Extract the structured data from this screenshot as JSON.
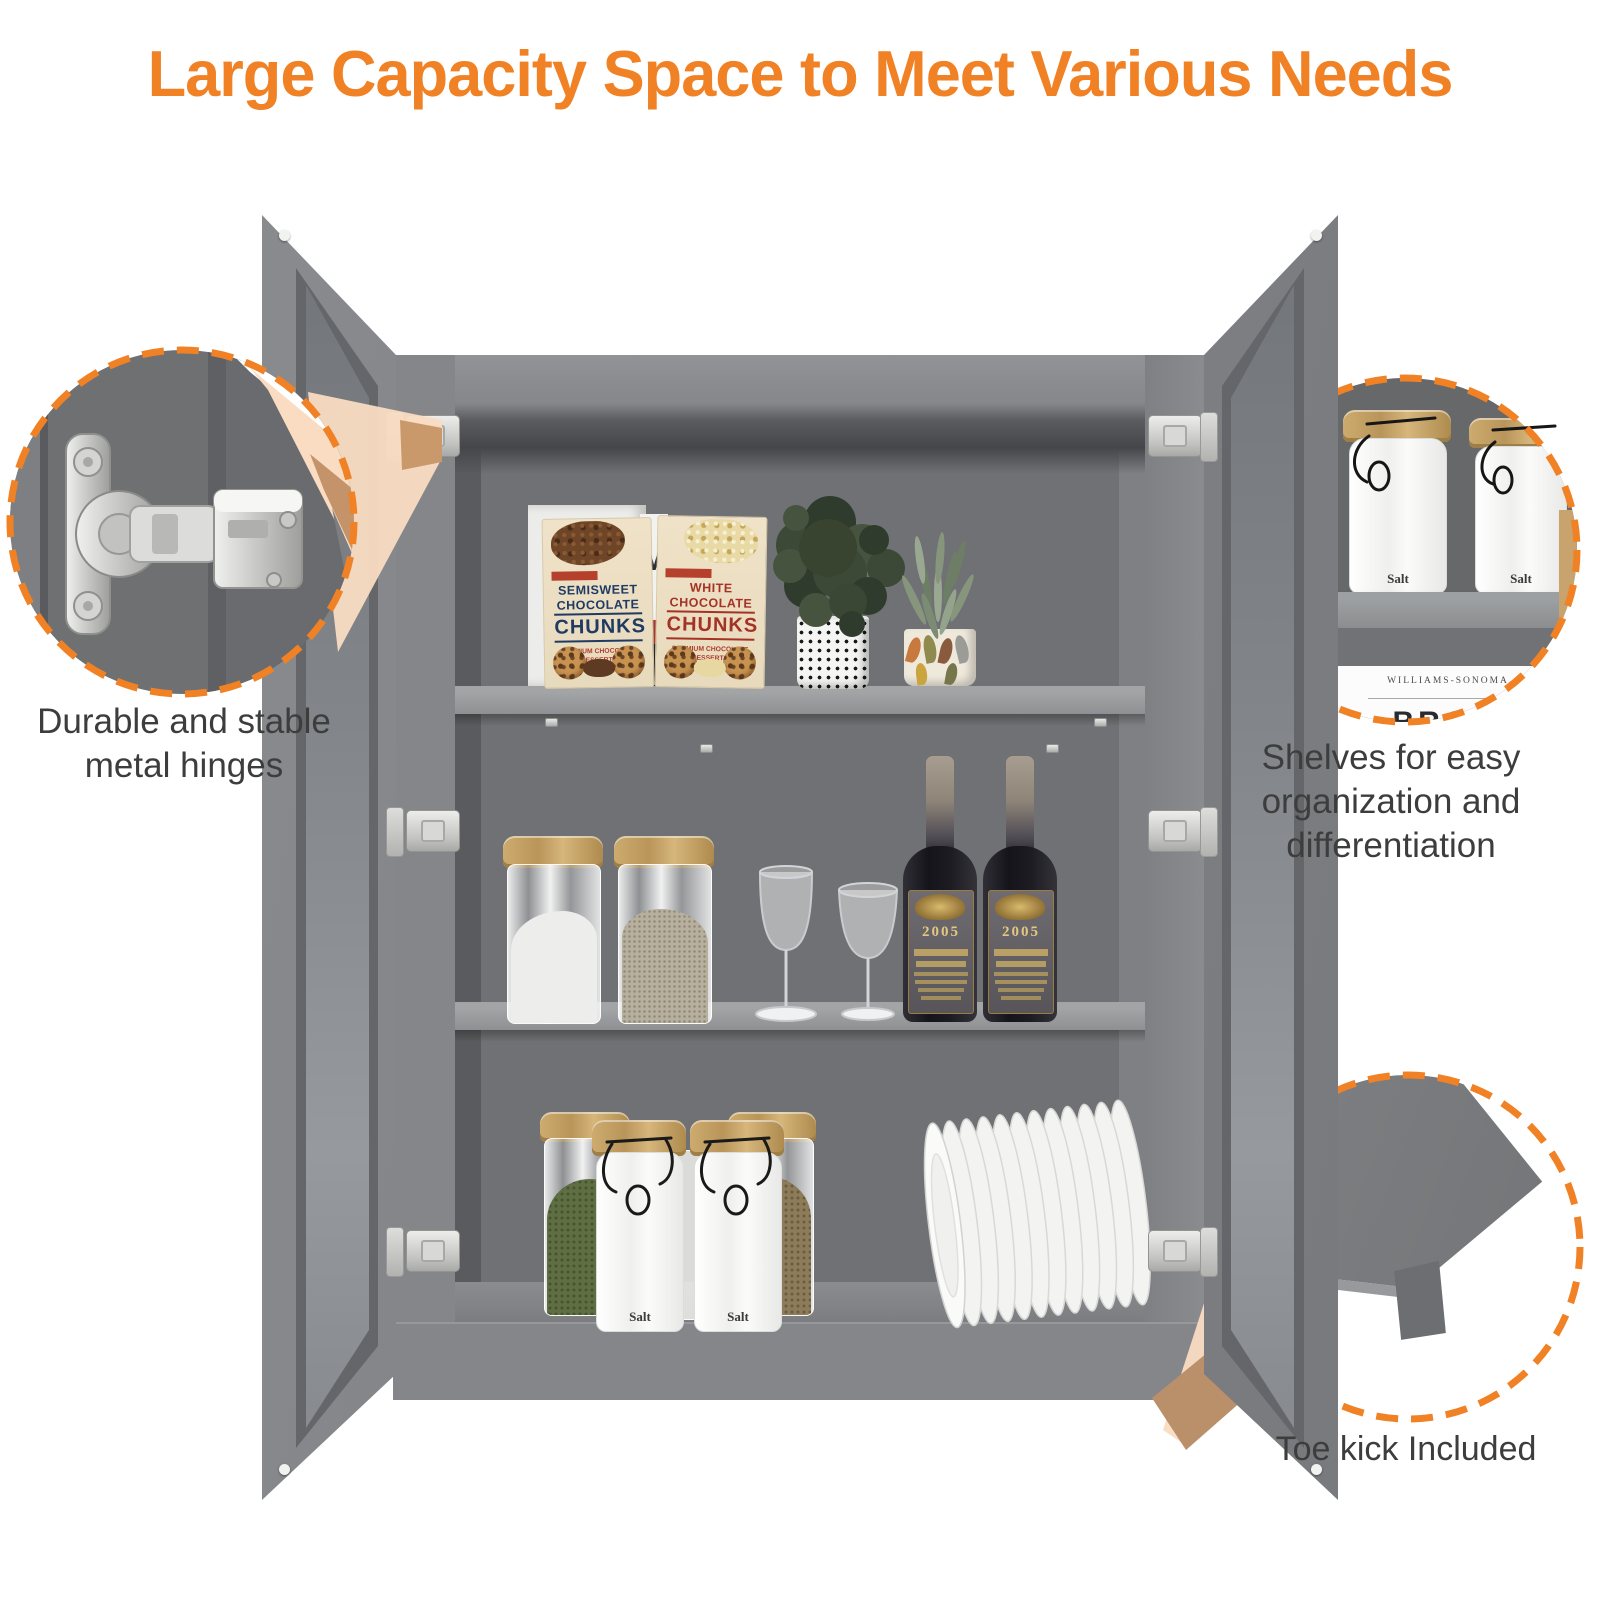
{
  "title": {
    "text": "Large Capacity Space to Meet Various Needs"
  },
  "callouts": {
    "hinge": "Durable and stable metal hinges",
    "shelves": "Shelves for easy organization and differentiation",
    "toe_kick": "Toe kick Included"
  },
  "products": {
    "chocolate_left": {
      "line1": "SEMISWEET",
      "line2": "CHOCOLATE",
      "line3": "CHUNKS",
      "subtitle": "PREMIUM CHOCOLATE FOR DESSERTS AND PASTRIES",
      "tagline": "PERFECT FOR BAKING"
    },
    "chocolate_right": {
      "line1": "WHITE",
      "line2": "CHOCOLATE",
      "line3": "CHUNKS",
      "subtitle": "PREMIUM CHOCOLATE FOR DESSERTS AND PASTRIES",
      "tagline": "PERFECT FOR BAKING"
    },
    "back_box_letter": "M",
    "wine_year": "2005",
    "salt_label": "Salt",
    "pantry_box_brand": "WILLIAMS-SONOMA",
    "pantry_box_partial": "BROW"
  },
  "colors": {
    "accent_orange": "#F08124",
    "beam_peach": "#F9DCC2",
    "cabinet_gray": "#85878B",
    "interior_gray": "#6F7174",
    "text_dark": "#3D3D3D"
  }
}
